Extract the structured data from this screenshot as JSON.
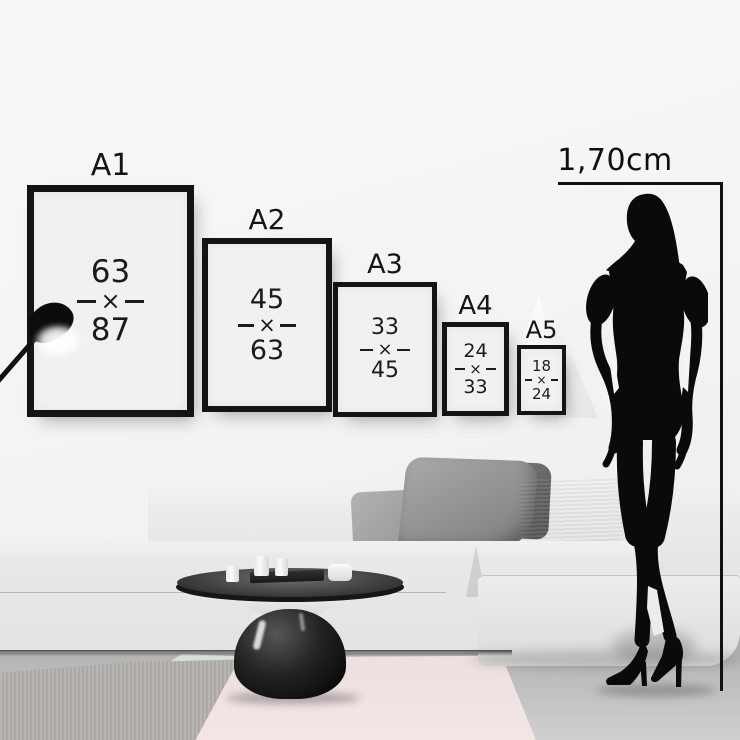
{
  "scene": {
    "person_height_label": "1,70cm",
    "separator": "×",
    "colors": {
      "line": "#111111",
      "frame_border": "#141414",
      "frame_paper": "#f1f1ef",
      "wall": "#f4f4f3",
      "floor": "#adadad",
      "rug_pink": "#f0e1e0",
      "rug_gray": "#b2afac",
      "rug_yellow": "#f2e9b4",
      "sofa": "#e9e9e8",
      "silhouette": "#0a0a0a"
    }
  },
  "frames": [
    {
      "label": "A1",
      "width_value": "63",
      "height_value": "87"
    },
    {
      "label": "A2",
      "width_value": "45",
      "height_value": "63"
    },
    {
      "label": "A3",
      "width_value": "33",
      "height_value": "45"
    },
    {
      "label": "A4",
      "width_value": "24",
      "height_value": "33"
    },
    {
      "label": "A5",
      "width_value": "18",
      "height_value": "24"
    }
  ]
}
